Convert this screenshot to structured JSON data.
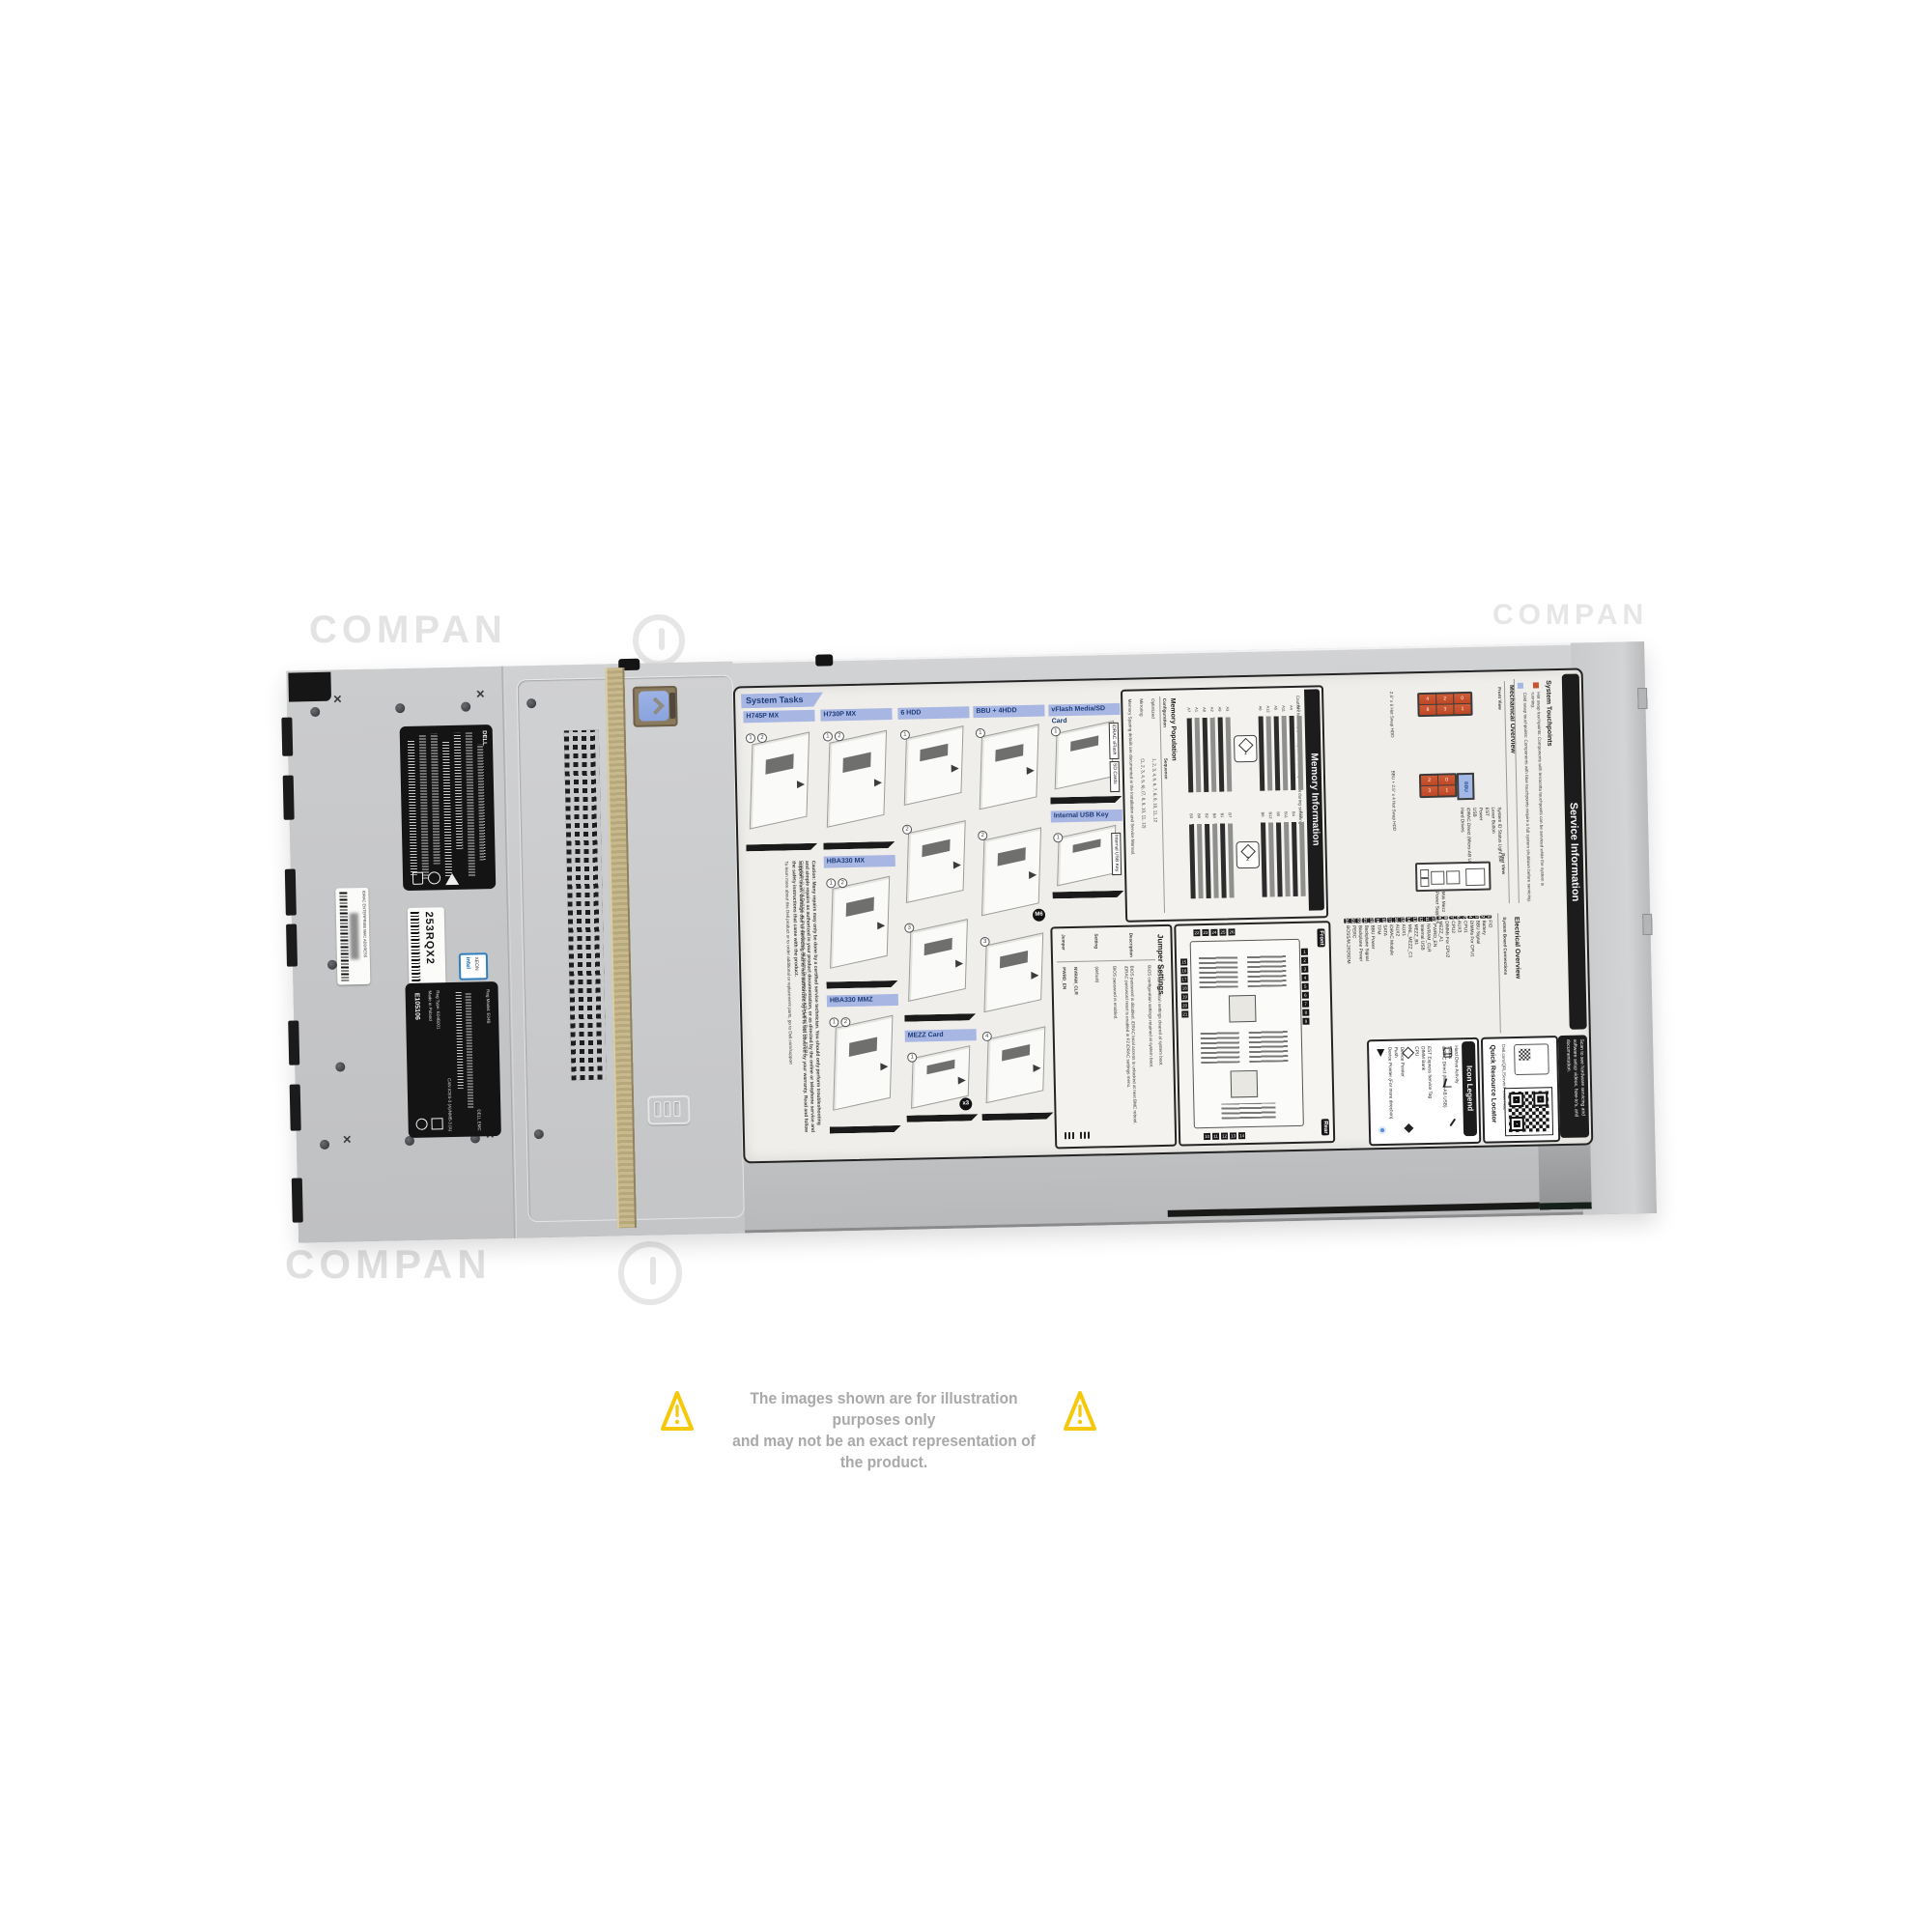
{
  "disclaimer": {
    "line1": "The images shown are for illustration purposes only",
    "line2": "and may not be an exact representation of the product."
  },
  "watermark": {
    "text": "COMPAN"
  },
  "chassis": {
    "brand": "DELL",
    "service_tag": "253RQX2",
    "mac_label": "IDRAC ENTERPRISE MAC ADDRESS",
    "intel_badge": {
      "line1": "intel",
      "line2": "XEON"
    },
    "reg_label": {
      "ul_code": "E105106",
      "model": "Reg Model: E04B",
      "made_in": "Made in Poland",
      "reg_type": "Reg Type: E04B001",
      "ices": "CAN ICES-3 (A)/NMB-3 (A)",
      "brand": "DELL EMC"
    }
  },
  "label": {
    "system_tasks_title": "System Tasks",
    "tiles": [
      {
        "name": "H745P MX"
      },
      {
        "name": "H730P MX"
      },
      {
        "name": "HBA330 MX"
      },
      {
        "name": "HBA330 MMZ"
      },
      {
        "name": "6 HDD"
      },
      {
        "name": "MEZZ Card",
        "badge": "x3"
      },
      {
        "name": "BBU + 4HDD",
        "badge": "M6"
      },
      {
        "name": "vFlash Media/SD Card",
        "callout1": "iDRAC vFlash",
        "callout2": "SD Cards"
      },
      {
        "name": "Internal USB Key",
        "callout1": "Internal USB Key"
      }
    ],
    "caution": "Caution: Many repairs may only be done by a certified service technician. You should only perform troubleshooting and simple repairs as authorized in your product documentation, or as directed by the online or telephone service and support team. Damage due to servicing that is not authorized by Dell is not covered by your warranty. Read and follow the safety instructions that came with the product.",
    "support_note": "To learn more about this Dell product or to order additional or replacement parts, go to Dell.com/support",
    "copyright": "Copyright © 2018 Dell Inc. or its subsidiaries. All Rights Reserved. Rev A00. Label Part No. F7FDJ.",
    "memory": {
      "title": "Memory Information",
      "caution": "Caution: Memory (DIMMs) and CPUs may be hot during servicing",
      "population_title": "Memory Population",
      "col_configuration": "Configuration",
      "col_sequence": "Sequence",
      "row1_config": "Optimized",
      "row1_seq": "1, 2, 3, 4, 5, 6, 7, 8, 9, 10, 11, 12",
      "row2_config": "Mirroring",
      "row2_seq": "(1, 2, 3, 4, 5, 6), (7, 8, 9, 10, 11, 12)",
      "sparing_note": "Memory Sparing details are documented in the Installation and Service Manual.",
      "cpu1_badge": "1",
      "cpu2_badge": "2",
      "slots_a_left": [
        "A7",
        "A1",
        "A8",
        "A2",
        "A9",
        "A3"
      ],
      "slots_a_right": [
        "A6",
        "A12",
        "A5",
        "A11",
        "A4",
        "A10"
      ],
      "slots_b_left": [
        "B3",
        "B9",
        "B2",
        "B8",
        "B1",
        "B7"
      ],
      "slots_b_right": [
        "B6",
        "B12",
        "B5",
        "B11",
        "B4",
        "B10"
      ]
    },
    "jumper": {
      "title": "Jumper Settings",
      "col_jumper": "Jumper",
      "col_setting": "Setting",
      "col_description": "Description",
      "row1_jumper": "PWRD_EN",
      "row1_default": "(default)",
      "row1_desc_default": "BIOS password is enabled.",
      "row1_desc_alt": "BIOS password is disabled. iDRAC local access is unlocked at next BMC reboot. iDRAC password reset is enabled in F2 iDRAC settings menu.",
      "row2_jumper": "NVRAM_CLR",
      "row2_default": "(default)",
      "row2_desc_default": "BIOS configuration settings retained at system boot.",
      "row2_desc_alt": "BIOS configuration settings cleared at system boot."
    },
    "board": {
      "front_tag": "Front",
      "rear_tag": "Rear",
      "numbers_top": [
        "22",
        "23",
        "24",
        "25",
        "26"
      ],
      "numbers_right": [
        "1",
        "2",
        "3",
        "4",
        "5",
        "6",
        "7",
        "8",
        "9"
      ],
      "numbers_bottom": [
        "10",
        "11",
        "12",
        "13",
        "14"
      ],
      "numbers_left": [
        "15",
        "16",
        "17",
        "18",
        "19",
        "20",
        "21"
      ]
    },
    "connections": {
      "overview_title": "Electrical Overview",
      "title": "System Board Connections",
      "items": [
        {
          "n": "1",
          "t": "FIO"
        },
        {
          "n": "2",
          "t": "Battery"
        },
        {
          "n": "3",
          "t": "BBU Signal"
        },
        {
          "n": "4",
          "t": "DIMMs For CPU1"
        },
        {
          "n": "5",
          "t": "CPU1"
        },
        {
          "n": "6",
          "t": "AUX3"
        },
        {
          "n": "7",
          "t": "CPU2"
        },
        {
          "n": "8",
          "t": "DIMMs For CPU2"
        },
        {
          "n": "9",
          "t": "MEZZ_A1"
        },
        {
          "n": "10",
          "t": "PWRD_EN"
        },
        {
          "n": "11",
          "t": "NVRAM_CLR"
        },
        {
          "n": "12",
          "t": "Internal USB"
        },
        {
          "n": "13",
          "t": "MEZZ_B1"
        },
        {
          "n": "14",
          "t": "MNL_MEZZ_C1"
        },
        {
          "n": "15",
          "t": "AUX1"
        },
        {
          "n": "16",
          "t": "AUX2"
        },
        {
          "n": "17",
          "t": "iDRAC Module"
        },
        {
          "n": "18",
          "t": "SATA"
        },
        {
          "n": "19",
          "t": "TPM"
        },
        {
          "n": "20",
          "t": "BBU Power"
        },
        {
          "n": "21",
          "t": "Backplane Signal"
        },
        {
          "n": "22",
          "t": "Backplane Power"
        },
        {
          "n": "23",
          "t": "PERC"
        },
        {
          "n": "24",
          "t": "BOSS/M.2/IDSDM"
        }
      ]
    },
    "mechanical": {
      "title": "Mechanical Overview",
      "front_view": "Front View",
      "rear_view": "Rear View",
      "front1_caption": "2.5\" x 6 Hot Swap HDD",
      "front2_caption": "BBU + 2.5\" x 4 Hot Swap HDD",
      "front1_drives": [
        "4",
        "8",
        "2",
        "3",
        "0",
        "1"
      ],
      "front2_drives": [
        "2",
        "3",
        "0",
        "1"
      ],
      "bbu_text": "BBU",
      "callouts": [
        "System ID Status Light Bar",
        "Lever Button",
        "EST",
        "Power",
        "USB",
        "iDRAC Direct (Micro-AB USB)",
        "Hard Drives"
      ],
      "rear_callouts": [
        "Mini Mezz",
        "Power Supplies"
      ]
    },
    "touchpoints": {
      "title": "System Touchpoints",
      "hot": "Hot swap touchpoints: Components with terracotta touchpoints can be serviced while the system is running.",
      "cold": "Cold swap touchpoints: Components with blue touchpoints require a full system shutdown before servicing."
    },
    "service_title": "Service Information",
    "scan_note": "Scan to see hardware servicing and software setup videos, how-to's, and documentation.",
    "qrl": {
      "title": "Quick Resource Locator",
      "url": "Dell.com/QRL/Server/PEMX740c"
    },
    "icon_legend": {
      "title": "Icon Legend",
      "col1": [
        "Hard Drive Activity",
        "Status",
        "iDRAC Direct (Micro-AB USB)"
      ],
      "col2": [
        "EST Express Service Tag",
        "DIMM Bank",
        "CPU"
      ],
      "col3": [
        "Device Pointer",
        "Push",
        "Device Pointer (For more direction)"
      ]
    }
  }
}
